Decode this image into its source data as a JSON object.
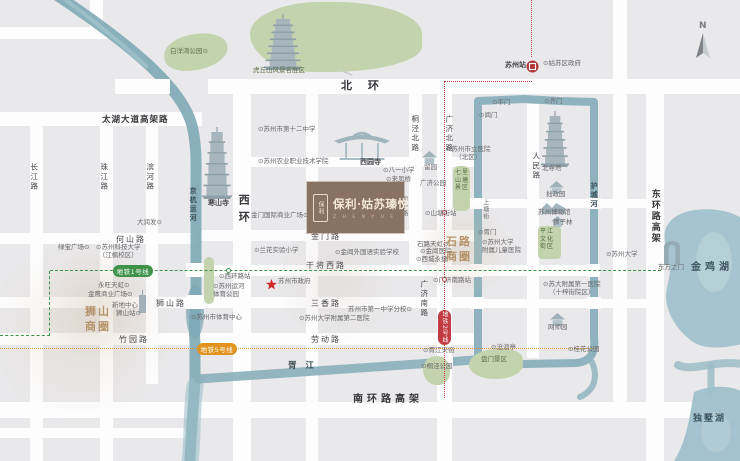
{
  "title": "保利·姑苏瑧悦 区位图",
  "project": {
    "name": "保利·姑苏瑧悦",
    "en": "Z H E N Y U E",
    "seal": "保利"
  },
  "compass": {
    "label": "N"
  },
  "colors": {
    "land": "#e9e8ea",
    "road": "#fdfdfe",
    "water": "#86aeba",
    "park": "#c3d3ad",
    "metro_line1": "#3f9249",
    "metro_line2": "#c13b42",
    "metro_line5": "#e2921f",
    "brand_brown": "#8a7262",
    "district_text": "#b18d63"
  },
  "metro": {
    "pills": [
      {
        "label": "地铁1号线",
        "x": 113,
        "y": 265,
        "w": 40,
        "h": 12,
        "color": "#3f9249",
        "vertical": false
      },
      {
        "label": "地铁5号线",
        "x": 197,
        "y": 343,
        "w": 40,
        "h": 12,
        "color": "#e2921f",
        "vertical": false
      },
      {
        "label": "地铁2号线",
        "x": 438,
        "y": 310,
        "w": 13,
        "h": 35,
        "color": "#c13b42",
        "vertical": true
      }
    ],
    "lines": [
      {
        "id": "line1",
        "color": "#3f9249",
        "style": "dashed",
        "segs": [
          [
            0,
            335,
            50,
            0
          ],
          [
            49,
            271,
            0,
            65
          ],
          [
            50,
            270,
            611,
            0
          ]
        ]
      },
      {
        "id": "line5",
        "color": "#e2921f",
        "style": "dotted",
        "segs": [
          [
            0,
            348,
            597,
            0
          ]
        ]
      },
      {
        "id": "line2",
        "color": "#c13b42",
        "style": "dotted",
        "segs": [
          [
            531,
            0,
            0,
            57
          ],
          [
            445,
            81,
            87,
            0
          ],
          [
            444,
            81,
            0,
            230
          ],
          [
            444,
            343,
            0,
            55
          ]
        ]
      }
    ],
    "stations": [
      [
        226,
        268,
        "#3f9249"
      ],
      [
        442,
        210,
        "#c13b42"
      ],
      [
        442,
        277,
        "#c13b42"
      ]
    ]
  },
  "roads": {
    "h": [
      [
        0,
        27,
        112,
        12
      ],
      [
        0,
        112,
        202,
        14
      ],
      [
        208,
        79,
        532,
        15
      ],
      [
        237,
        157,
        240,
        10
      ],
      [
        474,
        199,
        174,
        9
      ],
      [
        0,
        233,
        196,
        11
      ],
      [
        200,
        230,
        274,
        11
      ],
      [
        195,
        265,
        405,
        11
      ],
      [
        474,
        265,
        126,
        11
      ],
      [
        0,
        297,
        474,
        11
      ],
      [
        474,
        299,
        174,
        9
      ],
      [
        0,
        333,
        474,
        12
      ],
      [
        0,
        402,
        740,
        16
      ],
      [
        0,
        428,
        186,
        10
      ]
    ],
    "v": [
      [
        90,
        0,
        13,
        28
      ],
      [
        30,
        126,
        13,
        335
      ],
      [
        100,
        126,
        13,
        335
      ],
      [
        146,
        126,
        12,
        258
      ],
      [
        233,
        93,
        18,
        368
      ],
      [
        306,
        93,
        12,
        368
      ],
      [
        409,
        93,
        13,
        177
      ],
      [
        437,
        93,
        15,
        368
      ],
      [
        527,
        104,
        12,
        254
      ],
      [
        613,
        0,
        14,
        402
      ],
      [
        646,
        93,
        18,
        368
      ]
    ]
  },
  "bridges": [
    [
      115,
      79,
      55,
      15
    ],
    [
      186,
      263,
      18,
      14
    ],
    [
      186,
      295,
      18,
      14
    ],
    [
      470,
      264,
      13,
      13
    ],
    [
      587,
      264,
      13,
      13
    ],
    [
      470,
      198,
      14,
      11
    ],
    [
      587,
      198,
      14,
      11
    ],
    [
      470,
      297,
      14,
      12
    ],
    [
      587,
      297,
      14,
      12
    ],
    [
      433,
      356,
      20,
      10
    ]
  ],
  "circles": [
    [
      80,
      330,
      95,
      "rgba(205,185,155,0.20)"
    ],
    [
      100,
      305,
      58,
      "rgba(205,185,155,0.25)"
    ],
    [
      335,
      282,
      62,
      "rgba(210,200,188,0.28)"
    ],
    [
      462,
      250,
      50,
      "rgba(212,192,166,0.30)"
    ]
  ],
  "parks": [
    {
      "x": 164,
      "y": 34,
      "w": 64,
      "h": 36,
      "r": "55% 45% 60% 40%",
      "rot": -6
    },
    {
      "x": 250,
      "y": 2,
      "w": 172,
      "h": 70,
      "r": "45% 55% 60% 40% / 50% 50% 40% 60%",
      "rot": 0
    },
    {
      "x": 453,
      "y": 166,
      "w": 17,
      "h": 45,
      "r": "6px",
      "rot": 0
    },
    {
      "x": 538,
      "y": 226,
      "w": 23,
      "h": 33,
      "r": "4px",
      "rot": 0
    },
    {
      "x": 469,
      "y": 349,
      "w": 54,
      "h": 30,
      "r": "55% 45% 50% 60%",
      "rot": -4
    },
    {
      "x": 423,
      "y": 356,
      "w": 27,
      "h": 29,
      "r": "50% 50% 45% 55%",
      "rot": 0
    },
    {
      "x": 204,
      "y": 257,
      "w": 10,
      "h": 47,
      "r": "5px",
      "rot": 0
    }
  ],
  "icons": [
    {
      "type": "pagoda",
      "tiers": 6,
      "name": "hanshan-temple-pagoda-icon",
      "x": 202,
      "y": 127,
      "w": 30,
      "h": 72
    },
    {
      "type": "pagoda",
      "tiers": 7,
      "name": "huqiu-tower-icon",
      "x": 264,
      "y": 14,
      "w": 38,
      "h": 56
    },
    {
      "type": "pagoda",
      "tiers": 6,
      "name": "north-temple-pagoda-icon",
      "x": 541,
      "y": 111,
      "w": 28,
      "h": 56
    },
    {
      "type": "gate",
      "name": "xiyuan-temple-icon",
      "x": 334,
      "y": 126,
      "w": 56,
      "h": 34
    },
    {
      "type": "pavilion",
      "name": "liuyuan-garden-icon",
      "x": 422,
      "y": 149,
      "w": 15,
      "h": 13
    },
    {
      "type": "pavilion",
      "name": "zhuozhengyuan-garden-icon",
      "x": 549,
      "y": 179,
      "w": 15,
      "h": 13
    },
    {
      "type": "museum",
      "name": "suzhou-museum-icon",
      "x": 542,
      "y": 199,
      "w": 23,
      "h": 11
    },
    {
      "type": "pavilion",
      "name": "lion-grove-garden-icon",
      "x": 551,
      "y": 212,
      "w": 13,
      "h": 11
    },
    {
      "type": "pavilion",
      "name": "wangshiyuan-garden-icon",
      "x": 550,
      "y": 311,
      "w": 15,
      "h": 13
    },
    {
      "type": "door",
      "name": "gate-of-orient-icon",
      "x": 663,
      "y": 240,
      "w": 18,
      "h": 25
    },
    {
      "type": "tower",
      "name": "skyscraper-icon",
      "x": 138,
      "y": 290,
      "w": 9,
      "h": 23
    },
    {
      "type": "station",
      "name": "suzhou-railway-station-icon",
      "x": 526,
      "y": 58,
      "w": 13,
      "h": 13
    },
    {
      "type": "star",
      "name": "government-star-icon",
      "x": 266,
      "y": 275,
      "w": 11,
      "h": 11
    }
  ],
  "labels": [
    {
      "t": "白洋湾公园⊙",
      "x": 170,
      "y": 47,
      "c": "pk",
      "n": "baiyangwan-park-label"
    },
    {
      "t": "虎丘山风景名胜区",
      "x": 253,
      "y": 66,
      "c": "pk",
      "n": "huqiu-scenic-area-label"
    },
    {
      "t": "北 环",
      "x": 341,
      "y": 79,
      "c": "hwy",
      "n": "north-ring-road-label"
    },
    {
      "t": "太湖大道高架路",
      "x": 102,
      "y": 115,
      "c": "hwy2",
      "n": "taihu-avenue-label"
    },
    {
      "t": "西环",
      "x": 236,
      "y": 194,
      "c": "hwyv",
      "n": "west-ring-road-label"
    },
    {
      "t": "东环路高架",
      "x": 648,
      "y": 189,
      "c": "hwyv sm2",
      "n": "east-ring-elevated-label"
    },
    {
      "t": "南环路高架",
      "x": 353,
      "y": 393,
      "c": "hwy3",
      "n": "south-ring-elevated-label"
    },
    {
      "t": "京杭运河",
      "x": 188,
      "y": 187,
      "c": "wv",
      "n": "grand-canal-label"
    },
    {
      "t": "护城河",
      "x": 589,
      "y": 182,
      "c": "wv",
      "n": "moat-label"
    },
    {
      "t": "胥江",
      "x": 288,
      "y": 361,
      "c": "wh",
      "n": "xujiang-river-label"
    },
    {
      "t": "金鸡湖",
      "x": 691,
      "y": 261,
      "c": "lake",
      "n": "jinji-lake-label"
    },
    {
      "t": "独墅湖",
      "x": 693,
      "y": 414,
      "c": "lake sm3",
      "n": "dushu-lake-label"
    },
    {
      "t": "长江路",
      "x": 29,
      "y": 163,
      "c": "rlv"
    },
    {
      "t": "珠江路",
      "x": 99,
      "y": 163,
      "c": "rlv"
    },
    {
      "t": "滨河路",
      "x": 145,
      "y": 163,
      "c": "rlv"
    },
    {
      "t": "何山路",
      "x": 116,
      "y": 235,
      "c": "rl"
    },
    {
      "t": "狮山路",
      "x": 156,
      "y": 299,
      "c": "rl"
    },
    {
      "t": "竹园路",
      "x": 119,
      "y": 335,
      "c": "rl"
    },
    {
      "t": "金门路",
      "x": 311,
      "y": 232,
      "c": "rl"
    },
    {
      "t": "干将西路",
      "x": 306,
      "y": 261,
      "c": "rl"
    },
    {
      "t": "三香路",
      "x": 311,
      "y": 299,
      "c": "rl"
    },
    {
      "t": "劳动路",
      "x": 311,
      "y": 335,
      "c": "rl"
    },
    {
      "t": "桐泾北路",
      "x": 410,
      "y": 115,
      "c": "rlv"
    },
    {
      "t": "广济北路",
      "x": 444,
      "y": 115,
      "c": "rlv"
    },
    {
      "t": "广济南路",
      "x": 419,
      "y": 280,
      "c": "rlv"
    },
    {
      "t": "人民路",
      "x": 531,
      "y": 152,
      "c": "rlv"
    },
    {
      "t": "桐泾路",
      "x": 400,
      "y": 196,
      "c": "rlv sm"
    },
    {
      "t": "上塘街",
      "x": 481,
      "y": 199,
      "c": "rlv sm"
    },
    {
      "t": "大润发⊙",
      "x": 137,
      "y": 218,
      "c": ""
    },
    {
      "t": "绿宝广场⊙",
      "x": 58,
      "y": 243,
      "c": ""
    },
    {
      "t": "⊙苏州科技大学\n（江枫校区）",
      "x": 96,
      "y": 243,
      "c": "ctr"
    },
    {
      "t": "永旺天虹⊙",
      "x": 98,
      "y": 281,
      "c": ""
    },
    {
      "t": "金鹰商业广场⊙",
      "x": 88,
      "y": 290,
      "c": ""
    },
    {
      "t": "狮山\n商圈",
      "x": 85,
      "y": 305,
      "c": "biz",
      "n": "shishan-business-district-label"
    },
    {
      "t": "新地中心",
      "x": 112,
      "y": 301,
      "c": ""
    },
    {
      "t": "狮山站⊙",
      "x": 116,
      "y": 309,
      "c": ""
    },
    {
      "t": "⊙西环路站",
      "x": 219,
      "y": 272,
      "c": ""
    },
    {
      "t": "⊙苏州运河\n体育公园",
      "x": 213,
      "y": 282,
      "c": ""
    },
    {
      "t": "⊙苏州市体育中心",
      "x": 191,
      "y": 313,
      "c": ""
    },
    {
      "t": "寒山寺",
      "x": 208,
      "y": 199,
      "c": "poib",
      "n": "hanshan-temple-label"
    },
    {
      "t": "⊙苏州市第十二中学",
      "x": 258,
      "y": 125,
      "c": ""
    },
    {
      "t": "⊙苏州农业职业技术学院",
      "x": 258,
      "y": 157,
      "c": ""
    },
    {
      "t": "西园寺",
      "x": 360,
      "y": 158,
      "c": "poib",
      "n": "xiyuan-temple-label"
    },
    {
      "t": "⊙八一小学",
      "x": 383,
      "y": 166,
      "c": ""
    },
    {
      "t": "⊙来凤桥",
      "x": 386,
      "y": 175,
      "c": ""
    },
    {
      "t": "金门国际商业广场⊙",
      "x": 251,
      "y": 211,
      "c": ""
    },
    {
      "t": "⊙兰花实验小学",
      "x": 254,
      "y": 246,
      "c": ""
    },
    {
      "t": "⊙金阊外国语实验学校",
      "x": 335,
      "y": 248,
      "c": ""
    },
    {
      "t": "苏州市政府",
      "x": 278,
      "y": 277,
      "c": "",
      "n": "city-government-label"
    },
    {
      "t": "苏州市第一中学分校⊙",
      "x": 348,
      "y": 305,
      "c": ""
    },
    {
      "t": "⊙苏州大学附属第二医院",
      "x": 299,
      "y": 314,
      "c": ""
    },
    {
      "t": "留园",
      "x": 424,
      "y": 163,
      "c": "",
      "n": "liuyuan-garden-label"
    },
    {
      "t": "广济公园",
      "x": 420,
      "y": 179,
      "c": ""
    },
    {
      "t": "⊙苏州市立医院\n（北区）",
      "x": 446,
      "y": 145,
      "c": "ctr"
    },
    {
      "t": "七里\n山塘\n景区",
      "x": 455,
      "y": 169,
      "c": "pkt",
      "n": "shantang-scenic-label"
    },
    {
      "t": "⊙山塘街站",
      "x": 425,
      "y": 209,
      "c": ""
    },
    {
      "t": "石路天虹⊙",
      "x": 417,
      "y": 240,
      "c": ""
    },
    {
      "t": "⊙金阊医院",
      "x": 420,
      "y": 247,
      "c": ""
    },
    {
      "t": "⊙西城永捷",
      "x": 416,
      "y": 255,
      "c": ""
    },
    {
      "t": "石路\n商圈",
      "x": 446,
      "y": 235,
      "c": "biz",
      "n": "shilu-business-district-label"
    },
    {
      "t": "⊙胥门",
      "x": 478,
      "y": 228,
      "c": ""
    },
    {
      "t": "⊙苏州大学\n附属儿童医院",
      "x": 482,
      "y": 238,
      "c": ""
    },
    {
      "t": "⊙广济南路站",
      "x": 433,
      "y": 276,
      "c": ""
    },
    {
      "t": "⊙平门",
      "x": 492,
      "y": 98,
      "c": ""
    },
    {
      "t": "⊙齐门",
      "x": 544,
      "y": 97,
      "c": ""
    },
    {
      "t": "⊙阊门",
      "x": 479,
      "y": 111,
      "c": ""
    },
    {
      "t": "苏州站",
      "x": 505,
      "y": 61,
      "c": "poib",
      "n": "suzhou-station-label"
    },
    {
      "t": "⊙姑苏区政府",
      "x": 543,
      "y": 59,
      "c": ""
    },
    {
      "t": "北寺塔",
      "x": 542,
      "y": 164,
      "c": ""
    },
    {
      "t": "拙政园",
      "x": 546,
      "y": 190,
      "c": ""
    },
    {
      "t": "苏州博物馆",
      "x": 538,
      "y": 208,
      "c": ""
    },
    {
      "t": "狮子林",
      "x": 553,
      "y": 218,
      "c": ""
    },
    {
      "t": "平江\n文化\n街区",
      "x": 540,
      "y": 228,
      "c": "pkt"
    },
    {
      "t": "⊙苏州大学",
      "x": 606,
      "y": 250,
      "c": ""
    },
    {
      "t": "⊙苏大附属第一医院\n（十梓街院区）",
      "x": 543,
      "y": 280,
      "c": "ctr"
    },
    {
      "t": "网师园",
      "x": 548,
      "y": 323,
      "c": ""
    },
    {
      "t": "⊙桂花公园",
      "x": 568,
      "y": 345,
      "c": ""
    },
    {
      "t": "⊙沧浪亭",
      "x": 491,
      "y": 343,
      "c": ""
    },
    {
      "t": "⊙胥江天街",
      "x": 423,
      "y": 346,
      "c": ""
    },
    {
      "t": "⊙桐泾公园",
      "x": 421,
      "y": 362,
      "c": ""
    },
    {
      "t": "盘门景区",
      "x": 481,
      "y": 355,
      "c": "pk",
      "n": "panmen-scenic-label"
    },
    {
      "t": "东方之门",
      "x": 658,
      "y": 263,
      "c": "",
      "n": "gate-of-orient-label"
    }
  ]
}
